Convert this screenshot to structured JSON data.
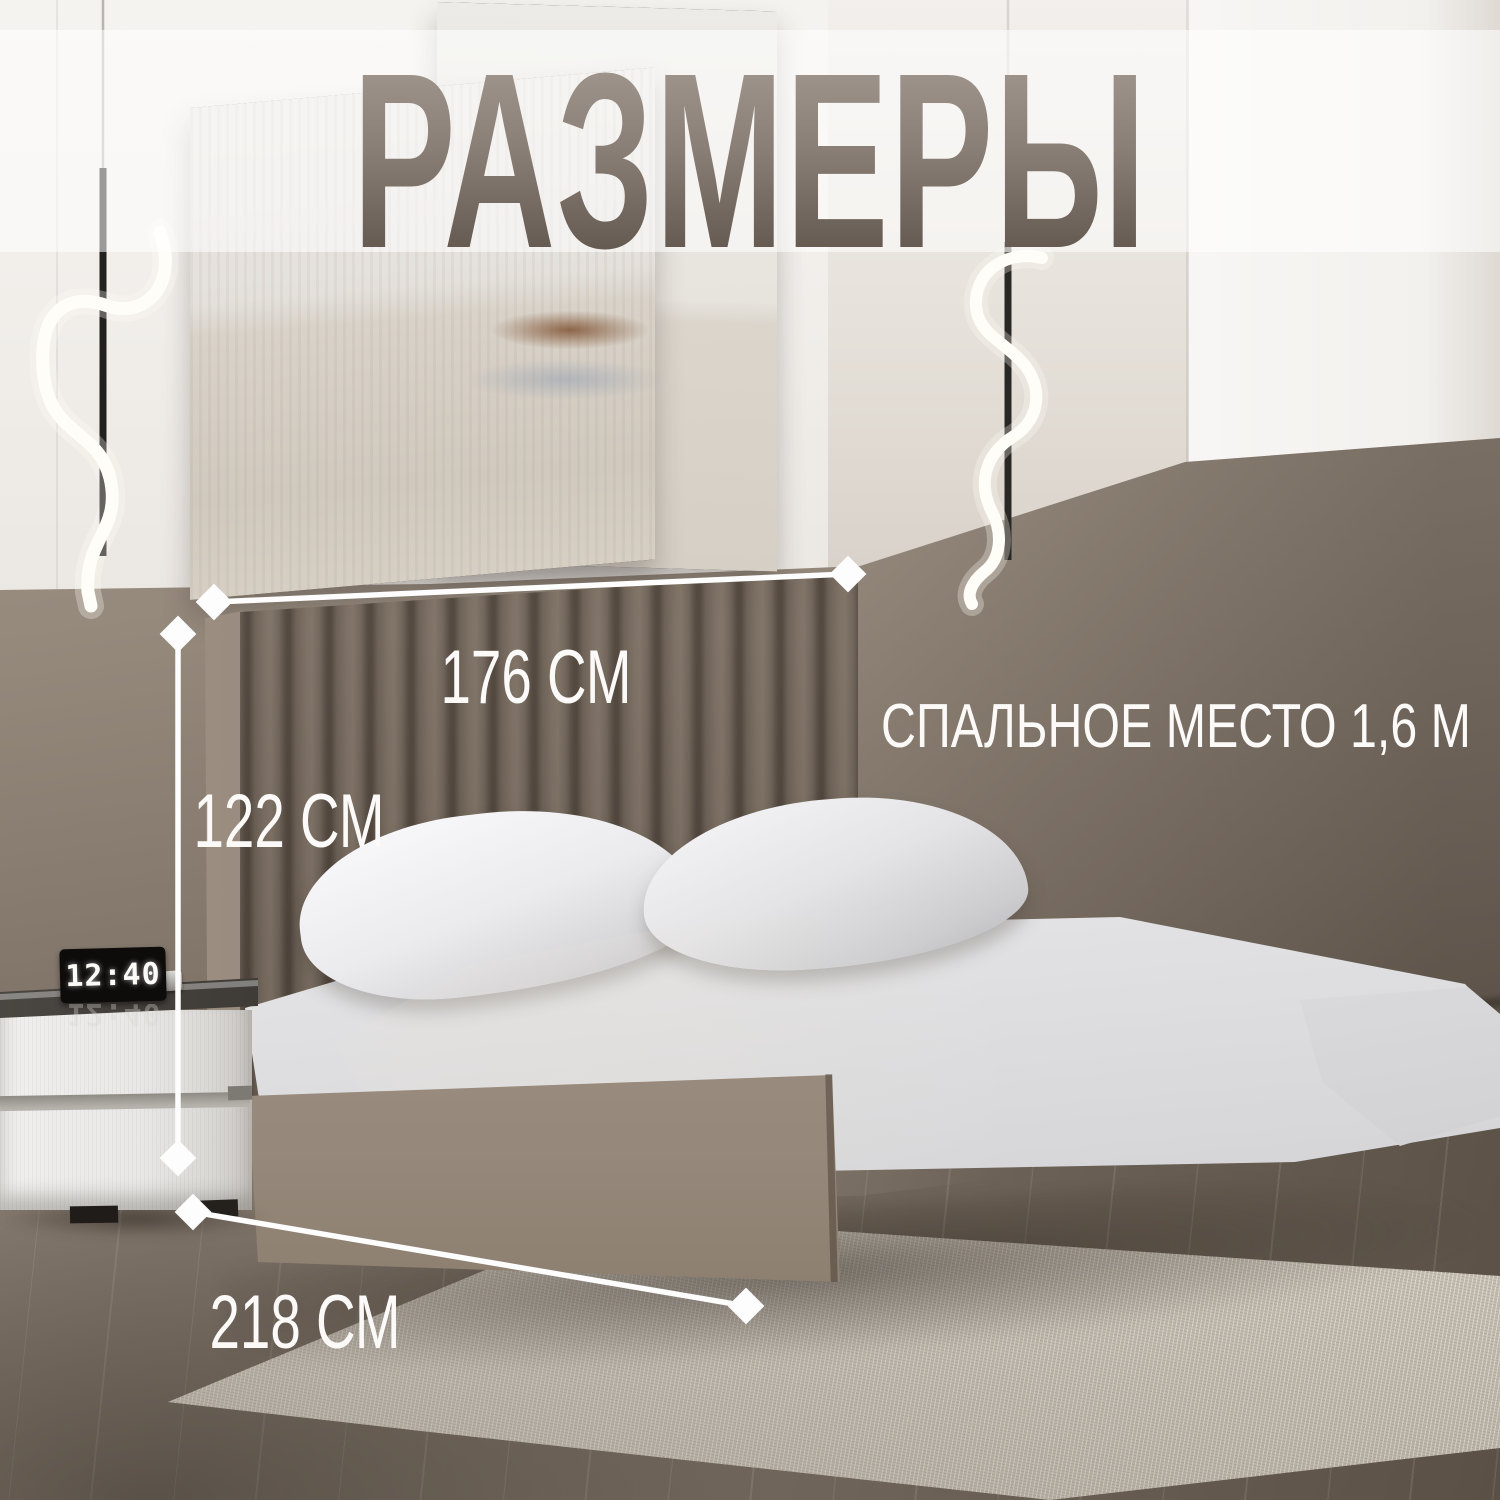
{
  "title": "РАЗМЕРЫ",
  "dimension_labels": {
    "headboard_width": "176 СМ",
    "headboard_height": "122 СМ",
    "bed_length": "218 СМ"
  },
  "sleeping_area_label": "СПАЛЬНОЕ МЕСТО 1,6 М",
  "clock": {
    "time": "12:40"
  },
  "colors": {
    "dimension_line": "#fdfdfd",
    "title_gradient_top": "#a69d95",
    "title_gradient_bottom": "#574d44",
    "wall_taupe": "#8d8175",
    "headboard_brown": "#6e6156",
    "bed_base_beige": "#a89a8a",
    "rug_cream": "#d6cfc4",
    "floor_wood": "#74695f"
  }
}
